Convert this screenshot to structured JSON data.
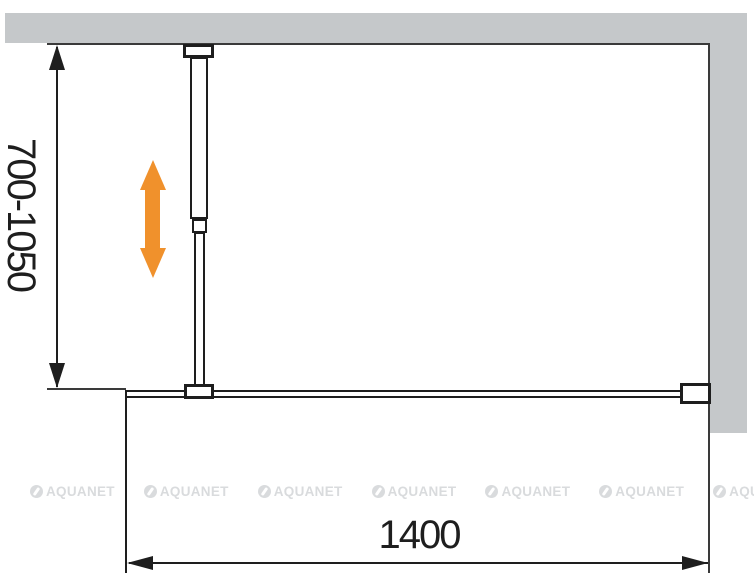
{
  "labels": {
    "height_range": "700-1050",
    "width": "1400"
  },
  "watermark": {
    "text": "AQUANET",
    "count": 7
  },
  "colors": {
    "wall_gray": "#c5c8ca",
    "line_black": "#1e1e1e",
    "arrow_orange": "#f0912c",
    "watermark_gray": "#d9dbdd"
  }
}
